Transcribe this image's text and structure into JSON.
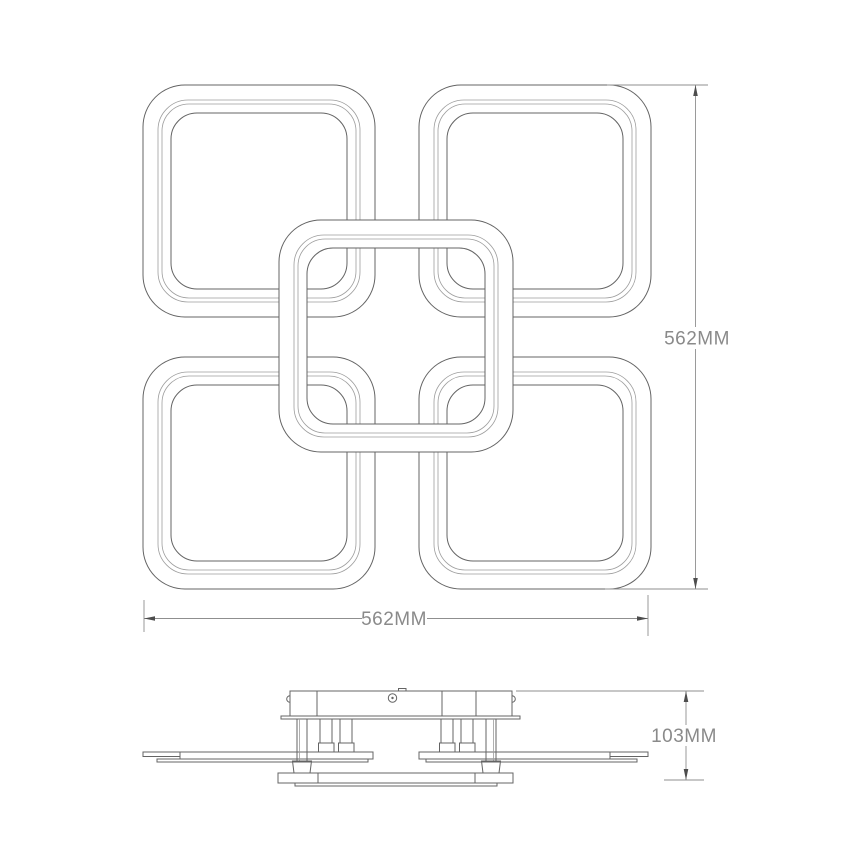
{
  "drawing": {
    "top_view": {
      "name": "top-view",
      "ring_count": 5
    },
    "side_view": {
      "name": "side-view"
    },
    "dimensions": {
      "height": {
        "label": "562MM"
      },
      "width": {
        "label": "562MM"
      },
      "fixture_height": {
        "label": "103MM"
      }
    }
  },
  "colors": {
    "background": "#ffffff",
    "outline": "#646464",
    "secondary_line": "#9d9d9d",
    "dimension_line": "#8f8f8f",
    "arrowhead": "#4d4d4d",
    "dimension_text": "#8a8a8a"
  }
}
